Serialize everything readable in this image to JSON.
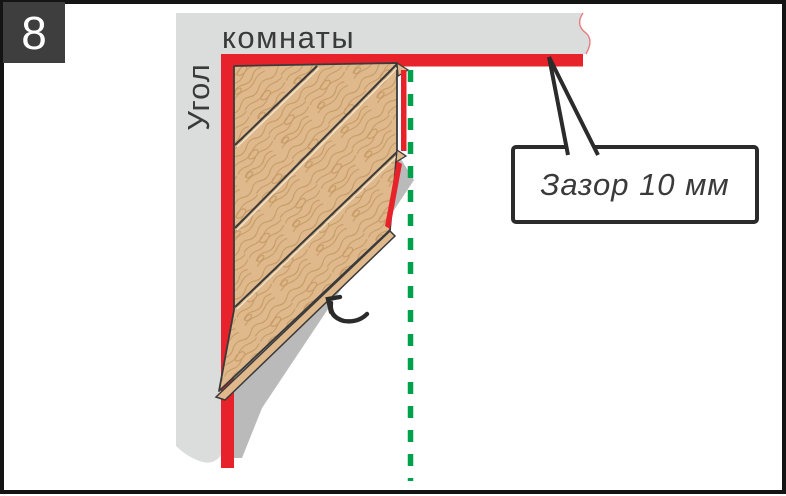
{
  "step_badge": {
    "number": "8"
  },
  "labels": {
    "wall_vertical": "Угол",
    "wall_horizontal": "комнаты"
  },
  "callout": {
    "text": "Зазор 10 мм"
  },
  "colors": {
    "red": "#E8222A",
    "green": "#00A14B",
    "wall_gray": "#DBDCDC",
    "shadow_gray": "#BABABA",
    "wood": "#DFB98C",
    "wood_grain": "#C1955F",
    "outline": "#3A3A3A",
    "badge_bg": "#3E3E3E",
    "badge_text": "#FFFFFF",
    "text": "#3A3A3A",
    "frame": "#141414",
    "callout_border": "#2B2B2B",
    "callout_bg": "#FFFFFF"
  }
}
